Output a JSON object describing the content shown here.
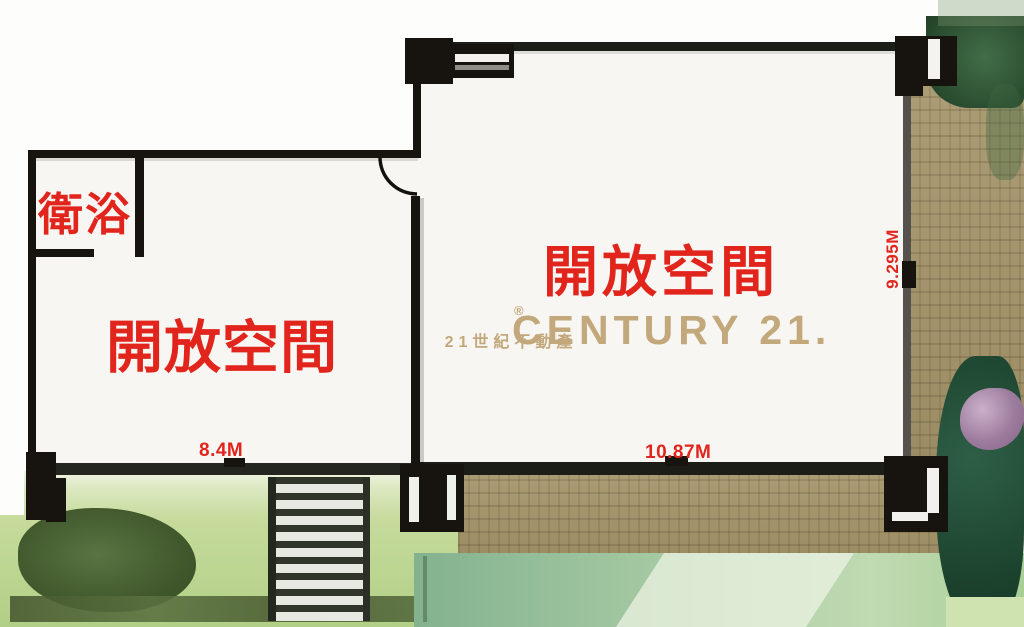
{
  "rooms": {
    "bathroom_label": "衛浴",
    "left_open_space_label": "開放空間",
    "right_open_space_label": "開放空間"
  },
  "dimensions": {
    "left_room_width": "8.4M",
    "right_room_width": "10.87M",
    "right_room_depth": "9.295M"
  },
  "watermark": {
    "brand": "CENTURY 21.",
    "registered_mark": "®",
    "subtitle": "21世紀不動產"
  },
  "colors": {
    "label_red": "#e1251c",
    "brand_gold": "#c2a87b",
    "wall_black": "#17140f",
    "deck_tan": "#a49469",
    "lawn_green": "#b2cf86",
    "tree_green": "#1d442f",
    "flower_purple": "#9c7c9e"
  }
}
